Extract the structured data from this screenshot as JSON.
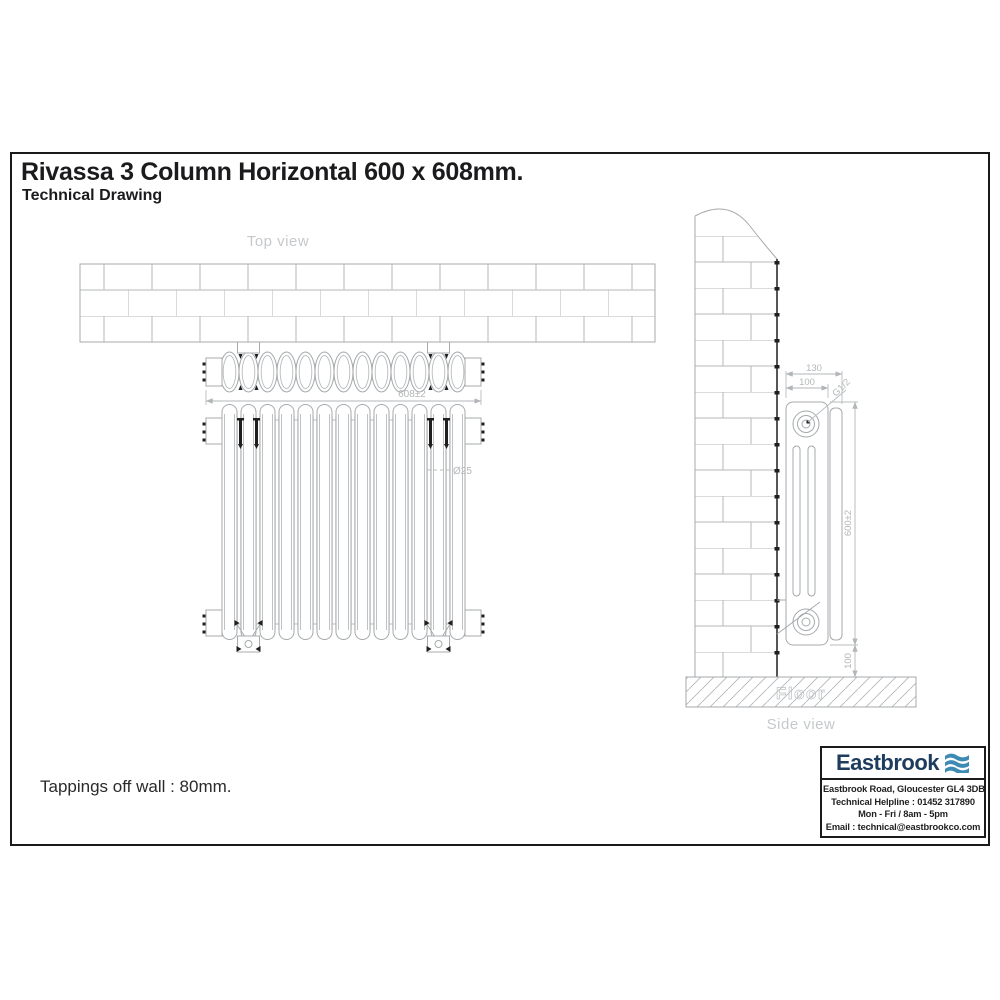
{
  "title": "Rivassa 3 Column Horizontal 600 x 608mm.",
  "subtitle": "Technical Drawing",
  "note": "Tappings off wall : 80mm.",
  "radiator": {
    "sections": 13
  },
  "views": {
    "top": {
      "label": "Top view",
      "dim_width": "608±2"
    },
    "front": {
      "dim_column_diameter": "Ø25"
    },
    "side": {
      "label": "Side view",
      "floor_label": "Floor",
      "dim_overall_depth": "130",
      "dim_depth": "100",
      "dim_tapping": "G1/2",
      "dim_height": "600±2",
      "dim_floor_clearance": "100"
    }
  },
  "brand": {
    "name": "Eastbrook",
    "logo_icon": "waves-icon",
    "address": "Eastbrook Road, Gloucester GL4 3DB",
    "helpline": "Technical Helpline : 01452 317890",
    "hours": "Mon - Fri / 8am - 5pm",
    "email": "Email : technical@eastbrookco.com",
    "colors": {
      "navy": "#1e3c5e",
      "wave_blue": "#3d8ab5"
    }
  }
}
